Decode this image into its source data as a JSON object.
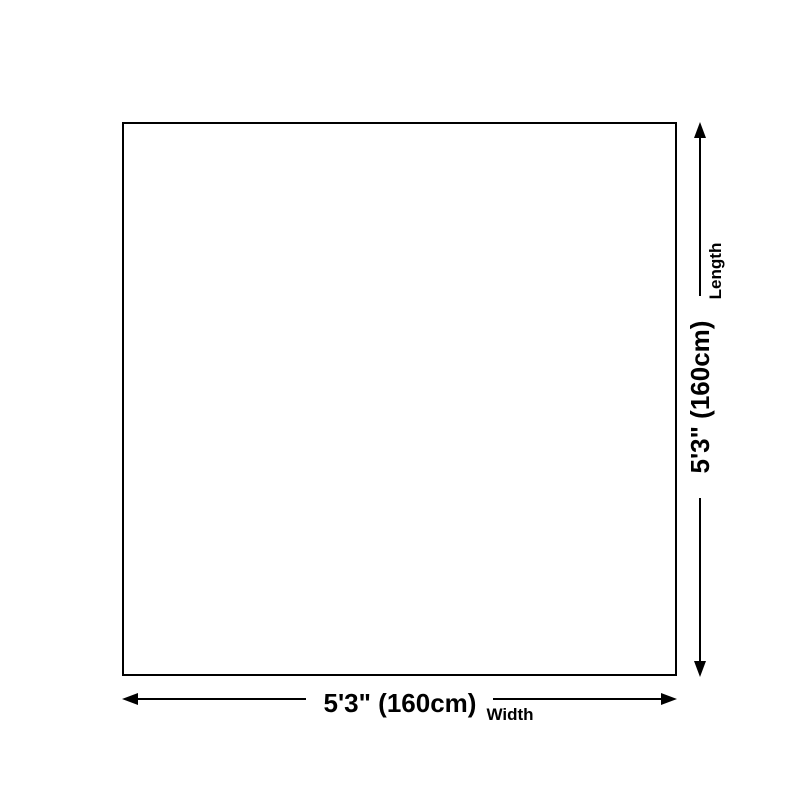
{
  "diagram": {
    "type": "product-size-diagram",
    "shape": "square",
    "dimensions": {
      "width": {
        "value": "5'3\" (160cm)",
        "label": "Width"
      },
      "length": {
        "value": "5'3\" (160cm)",
        "label": "Length"
      }
    },
    "colors": {
      "line": "#000000",
      "background": "#ffffff"
    }
  }
}
